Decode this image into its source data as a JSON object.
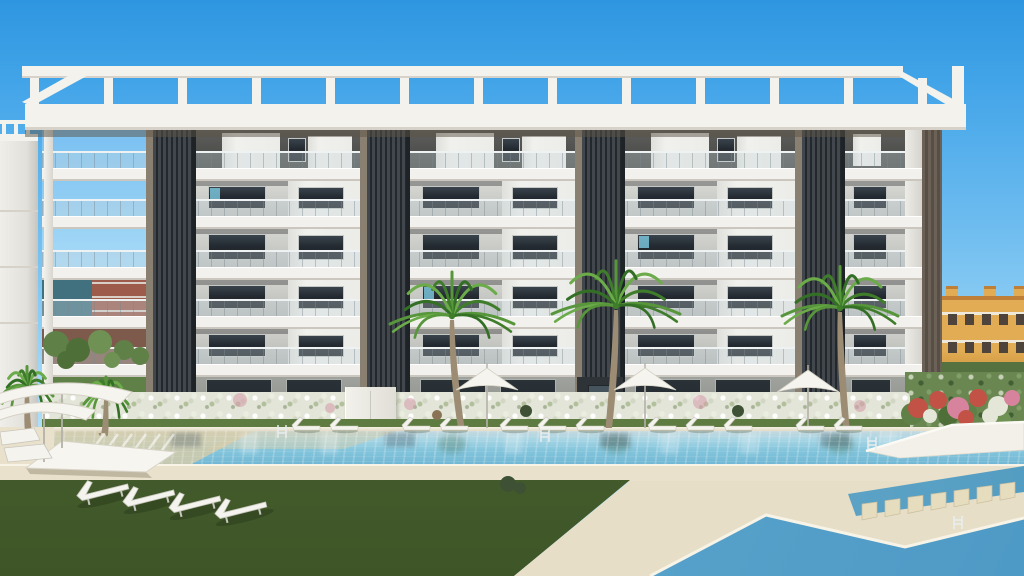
{
  "meta": {
    "aria_label": "Exterior render of a modern six-storey white apartment building with dark louvred pillars, rooftop pergola, glass balconies, palm trees, flowering hedges, sun loungers, parasols, lawns and turquoise swimming pools"
  },
  "palette": {
    "sky": "linear-gradient(180deg,#2E96E0 0%,#45A6E9 16%,#73BFF0 42%,#A5DAF7 68%,#CDEBFA 92%,#DBF2FC 100%)",
    "skyPatch": "linear-gradient(180deg,#79C0F1,#A9DBF7)",
    "white": "#F3F2ED",
    "whiteEdge": "#D6D2CA",
    "soffit": "rgba(92,84,70,0.5)",
    "louver": "repeating-linear-gradient(90deg,#23282C 0px,#23282C 2px,#41474C 2px,#41474C 5px)",
    "louverTrim": "#8A8072",
    "louverEdge": "#1E2327",
    "brown": "repeating-linear-gradient(90deg,#6C6156 0px,#6C6156 3px,#574E45 3px,#574E45 6px)",
    "sideWall": "linear-gradient(90deg,#EDECE7,#D5D3CC)",
    "post": "linear-gradient(90deg,#F2F1EC,#D8D5CE)",
    "slab": "#F2F1ED",
    "slabShadow": "#CBC7BF",
    "window": "linear-gradient(180deg,#39434C 0%,#242A31 45%,#1B2025 100%)",
    "windowFrame": "#C4C7C4",
    "glint": "#7ECCE4",
    "volume": "linear-gradient(90deg,#DFDFDB,#F0F0EC 25%,#ECECE8)",
    "door": "linear-gradient(180deg,#2A3238,#1E242A)",
    "entrance": "#2E3338",
    "entranceDoor": "#46545E",
    "grassStrip": "#5E7C42",
    "grassMain": "linear-gradient(180deg,#5A7740,#3E5527)",
    "deck": "#E9E1CB",
    "deckHL": "#F7F3E6",
    "deckWedge": "#E6DEC6",
    "coping": "linear-gradient(180deg,#F4F0E1,#DDD5BE)",
    "water": "linear-gradient(180deg,#C6D9DE 0%,#A6D5E4 25%,#84C5DC 55%,#6FB6D3 100%)",
    "waterChannel": "linear-gradient(90deg,#7FBCD6,#549DC2)",
    "waterFg": "linear-gradient(115deg,#8FCBE0 0%,#5AA5CC 55%,#4E9AC6 100%)",
    "sand": "#D8CCA6",
    "stone": "#E6DCBE",
    "stoneEdge": "#C9BE9F",
    "trunk": "#9C8C74",
    "fronds": [
      "#57963B",
      "#3F7D2B",
      "#6BAB49",
      "#346F26"
    ],
    "parasol": "#F5F4EE",
    "parasolEdge": "#D5D1C5",
    "pole": "#B4B1A8",
    "furn": "#F4F3ED",
    "furnEdge": "#C8C6BE",
    "teal": "#41707F",
    "red": "#9D5B4B",
    "redBand": "#D9CFC6",
    "redLow": "#7E5A4C",
    "town": "#E2AC54",
    "townRoof": "#BF7F39",
    "townTrim": "#EFE9DC",
    "townWin": "#4F443C",
    "townHedge": "#55713F",
    "farLeft": "linear-gradient(90deg,#F0EEE9,#E2E0DA 70%,#C7C5BF)",
    "greens": [
      "#5F8148",
      "#4E7038",
      "#6F9254"
    ],
    "flowers": [
      "#C25245",
      "#D8839D",
      "#E4E6D8"
    ],
    "pink": "rgba(214,160,172,0.6)",
    "ballBush": "#3E5134",
    "basket": "#8A7354",
    "ladder": "#E9EDEE",
    "refDark": "rgba(56,74,86,0.30)",
    "refGreen": "rgba(56,98,60,0.28)",
    "refWhite": "rgba(255,255,255,0.22)",
    "planter": "#F2F0E8",
    "planterEdge": "#DCD8CC",
    "planterTop": "#FBFAF4"
  },
  "scene": {
    "building": {
      "x": 42,
      "w": 863
    },
    "rows": [
      {
        "y": 130,
        "h": 38,
        "bg": "linear-gradient(180deg,#5E5F5C,#454643)",
        "type": "pent"
      },
      {
        "y": 181,
        "h": 35,
        "bg": "linear-gradient(180deg,#D9DAD6,#BEC0BC)"
      },
      {
        "y": 229,
        "h": 38,
        "bg": "linear-gradient(180deg,#D6D7D3,#BBBDB9)"
      },
      {
        "y": 280,
        "h": 36,
        "bg": "linear-gradient(180deg,#D3D4D0,#B8BAB6)"
      },
      {
        "y": 329,
        "h": 35,
        "bg": "linear-gradient(180deg,#D0D1CD,#B5B7B3)"
      },
      {
        "y": 377,
        "h": 50,
        "bg": "linear-gradient(180deg,#9FA29D,#878A85)",
        "type": "ground"
      }
    ],
    "slabs": {
      "x": 42,
      "w": 880,
      "h": 13,
      "ys": [
        168,
        216,
        267,
        316,
        364
      ]
    },
    "rails": {
      "x": 42,
      "w": 863,
      "h": 17,
      "ys": [
        151,
        199,
        250,
        299,
        347
      ]
    },
    "columns": {
      "w": 50,
      "y": 130,
      "h": 297,
      "xs": [
        146,
        360,
        575,
        795
      ]
    },
    "post": {
      "x": 44,
      "y": 130,
      "w": 9,
      "h": 297
    },
    "sideWall": {
      "x": 905,
      "y": 130,
      "w": 17,
      "h": 297
    },
    "brownCol": {
      "x": 922,
      "y": 130,
      "w": 20,
      "h": 262
    },
    "pergola": {
      "beam": {
        "x": 22,
        "y": 66,
        "w": 881,
        "h": 12
      },
      "fascia": {
        "x": 25,
        "y": 104,
        "w": 941,
        "h": 26
      },
      "soffit": {
        "x": 25,
        "y": 130,
        "w": 880,
        "h": 7
      },
      "posts": {
        "y": 78,
        "h": 26,
        "w": 9,
        "xs": [
          30,
          104,
          178,
          252,
          326,
          400,
          474,
          548,
          622,
          696,
          770,
          844,
          918
        ]
      },
      "endPost": {
        "x": 952,
        "y": 66,
        "w": 12,
        "h": 40
      },
      "braceL": [
        [
          22,
          102
        ],
        [
          32,
          106
        ],
        [
          94,
          72
        ],
        [
          84,
          67
        ]
      ],
      "braceR": [
        [
          884,
          67
        ],
        [
          894,
          67
        ],
        [
          962,
          104
        ],
        [
          952,
          108
        ]
      ]
    },
    "bays": [
      {
        "x": 196,
        "w": 164
      },
      {
        "x": 410,
        "w": 165
      },
      {
        "x": 625,
        "w": 170
      },
      {
        "x": 845,
        "w": 60,
        "small": true
      }
    ],
    "glints": [
      {
        "bay": 0,
        "row": 1
      },
      {
        "bay": 2,
        "row": 2
      },
      {
        "bay": 1,
        "row": 3
      }
    ],
    "entrance": {
      "x": 577,
      "y": 377,
      "w": 46,
      "h": 50,
      "door": {
        "x": 588,
        "y": 385,
        "w": 22,
        "h": 40
      }
    },
    "leftBay": {
      "x": 42,
      "w": 104,
      "sky": {
        "y": 130,
        "h": 142
      },
      "teal": {
        "x": 42,
        "y": 272,
        "w": 50,
        "h": 52
      },
      "red": {
        "x": 92,
        "y": 272,
        "w": 54,
        "h": 52
      },
      "bands": [
        282,
        296,
        310
      ],
      "low": {
        "y": 322,
        "h": 55
      },
      "ground": {
        "y": 377,
        "h": 50
      }
    },
    "farLeft": {
      "wall": {
        "x": 0,
        "y": 134,
        "w": 38,
        "h": 296
      },
      "rail": {
        "x": 0,
        "y": 120,
        "w": 36,
        "h": 4
      },
      "posts": [
        2,
        14,
        26
      ],
      "roof": {
        "y": 134,
        "h": 7
      },
      "lines": [
        210,
        266,
        322
      ]
    },
    "town": {
      "x": 942,
      "w": 82,
      "y": 300,
      "h": 72,
      "roofY": 296,
      "chimneys": [
        946,
        984,
        1014
      ],
      "chimY": 286,
      "chimW": 12,
      "chimH": 14,
      "winYs": [
        314,
        342
      ],
      "winX0": 948,
      "winStep": 17,
      "winW": 9,
      "winH": 11,
      "trims": [
        312,
        340
      ],
      "hedgeY": 362,
      "hedgeH": 14
    },
    "garden": {
      "x": 905,
      "y": 372,
      "w": 119,
      "h": 60
    },
    "hedge": {
      "x": 42,
      "y": 392,
      "w": 868,
      "h": 34
    },
    "serviceBox": {
      "x": 345,
      "y": 387,
      "w": 50,
      "h": 42
    },
    "grassStrip": {
      "x": 42,
      "y": 419,
      "w": 868,
      "h": 10
    },
    "pool": {
      "coping": {
        "x": 54,
        "y": 427,
        "w": 970,
        "h": 5
      },
      "water": {
        "x": 54,
        "y": 431,
        "w": 970,
        "h": 35
      }
    },
    "ledge1": [
      [
        54,
        431
      ],
      [
        254,
        431
      ],
      [
        188,
        466
      ],
      [
        54,
        466
      ]
    ],
    "ledge2": [
      [
        254,
        431
      ],
      [
        398,
        431
      ],
      [
        344,
        449
      ],
      [
        205,
        449
      ]
    ],
    "leftDeck": {
      "x": 0,
      "y": 427,
      "w": 54,
      "h": 39
    },
    "deckBand": {
      "x": 0,
      "y": 464,
      "w": 1024,
      "h": 18
    },
    "grassMainPts": [
      [
        0,
        480
      ],
      [
        630,
        480
      ],
      [
        514,
        576
      ],
      [
        0,
        576
      ]
    ],
    "deckWedgePts": [
      [
        630,
        481
      ],
      [
        1024,
        481
      ],
      [
        1024,
        518
      ],
      [
        905,
        547
      ],
      [
        766,
        515
      ],
      [
        650,
        576
      ],
      [
        514,
        576
      ]
    ],
    "channelPts": [
      [
        848,
        494
      ],
      [
        1024,
        466
      ],
      [
        1024,
        492
      ],
      [
        856,
        516
      ]
    ],
    "fgPoolPts": [
      [
        650,
        576
      ],
      [
        766,
        515
      ],
      [
        905,
        547
      ],
      [
        1024,
        518
      ],
      [
        1024,
        576
      ]
    ],
    "fgCoping": [
      [
        650,
        576
      ],
      [
        766,
        515
      ],
      [
        905,
        547
      ],
      [
        1024,
        518
      ]
    ],
    "stones": {
      "x0": 862,
      "y0": 504,
      "dx": 23,
      "dy": -3.3,
      "n": 7,
      "shape": [
        [
          0,
          0
        ],
        [
          15,
          -2
        ],
        [
          15,
          13
        ],
        [
          0,
          16
        ]
      ]
    },
    "planter": {
      "pts": [
        [
          866,
          451
        ],
        [
          952,
          425
        ],
        [
          1024,
          422
        ],
        [
          1024,
          450
        ],
        [
          900,
          458
        ]
      ],
      "top": [
        [
          866,
          451
        ],
        [
          952,
          425
        ],
        [
          1024,
          422
        ]
      ]
    },
    "reflections": {
      "palms": [
        452,
        616,
        840
      ],
      "cols": [
        171,
        385,
        600,
        820
      ],
      "whites": [
        240,
        320,
        505,
        660,
        740,
        880
      ]
    },
    "palms": [
      {
        "cx": 452,
        "cy": 316,
        "r": 62,
        "lean": 6,
        "gy": 428
      },
      {
        "cx": 616,
        "cy": 306,
        "r": 64,
        "lean": -5,
        "gy": 428
      },
      {
        "cx": 840,
        "cy": 308,
        "r": 58,
        "lean": 4,
        "gy": 428
      },
      {
        "cx": 27,
        "cy": 388,
        "r": 26,
        "lean": 2,
        "gy": 432
      },
      {
        "cx": 106,
        "cy": 396,
        "r": 22,
        "lean": -3,
        "gy": 433
      }
    ],
    "parasols": [
      {
        "cx": 487,
        "y": 376
      },
      {
        "cx": 645,
        "y": 376
      },
      {
        "cx": 808,
        "y": 378
      }
    ],
    "loungerRow": {
      "y": 416,
      "xs": [
        292,
        330,
        402,
        440,
        500,
        538,
        576,
        648,
        686,
        724,
        796,
        834
      ]
    },
    "balls": [
      [
        526,
        411
      ],
      [
        738,
        411
      ]
    ],
    "basket": [
      437,
      415
    ],
    "bushEdge": [
      [
        508,
        484,
        8
      ],
      [
        520,
        488,
        6
      ]
    ],
    "daybed": {
      "pts": [
        [
          26,
          468
        ],
        [
          62,
          441
        ],
        [
          176,
          452
        ],
        [
          146,
          472
        ]
      ],
      "shadow": [
        [
          26,
          468
        ],
        [
          146,
          472
        ],
        [
          152,
          478
        ],
        [
          30,
          474
        ]
      ]
    },
    "cornerParasols": [
      {
        "d": "M -8 396 Q 60 372 132 392 L 120 404 Q 58 384 0 404 Z",
        "pole": [
          62,
          388,
          62,
          448
        ]
      },
      {
        "d": "M -6 412 Q 40 394 96 410 L 86 420 Q 40 404 0 420 Z",
        "pole": [
          44,
          414,
          44,
          462
        ]
      }
    ],
    "cornerLoungers": [
      [
        [
          0,
          432
        ],
        [
          34,
          428
        ],
        [
          40,
          440
        ],
        [
          2,
          445
        ]
      ],
      [
        [
          4,
          448
        ],
        [
          44,
          444
        ],
        [
          52,
          458
        ],
        [
          8,
          462
        ]
      ]
    ],
    "fgLoungers": {
      "rot": -14,
      "xs": [
        [
          74,
          484
        ],
        [
          120,
          490
        ],
        [
          166,
          496
        ],
        [
          212,
          502
        ]
      ]
    },
    "ladders": [
      [
        282,
        425
      ],
      [
        545,
        429
      ],
      [
        872,
        437
      ],
      [
        958,
        516
      ]
    ],
    "hedgeBlobs": [
      [
        240,
        400,
        7
      ],
      [
        410,
        404,
        6
      ],
      [
        700,
        402,
        7
      ],
      [
        860,
        406,
        6
      ],
      [
        330,
        408,
        5
      ]
    ],
    "leftGreens": [
      [
        56,
        344,
        13
      ],
      [
        78,
        350,
        12
      ],
      [
        100,
        342,
        12
      ],
      [
        124,
        350,
        10
      ],
      [
        66,
        360,
        9
      ],
      [
        112,
        360,
        8
      ],
      [
        140,
        356,
        9
      ]
    ],
    "gardenGreens": [
      [
        912,
        414,
        11
      ],
      [
        948,
        416,
        10
      ],
      [
        1002,
        420,
        9
      ],
      [
        968,
        412,
        9
      ]
    ],
    "gardenFlowers": [
      [
        918,
        408,
        10,
        0
      ],
      [
        938,
        400,
        9,
        0
      ],
      [
        958,
        408,
        11,
        1
      ],
      [
        978,
        398,
        9,
        0
      ],
      [
        998,
        406,
        10,
        2
      ],
      [
        1012,
        398,
        8,
        1
      ],
      [
        966,
        418,
        8,
        0
      ],
      [
        930,
        416,
        7,
        2
      ],
      [
        990,
        416,
        8,
        2
      ]
    ]
  }
}
